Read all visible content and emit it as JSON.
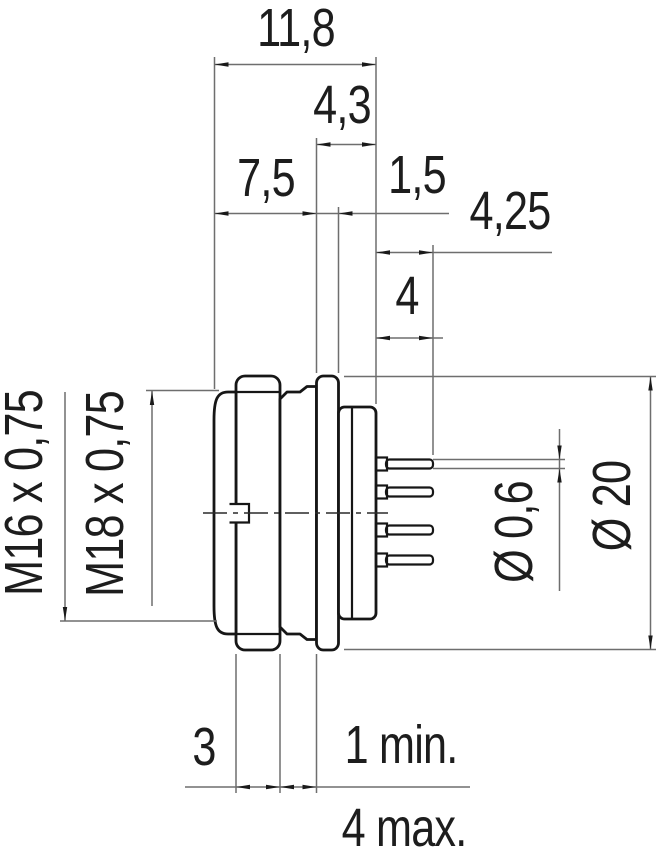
{
  "drawing": {
    "type": "connector-dimensional-drawing",
    "labels": {
      "total_length": "11,8",
      "rear_section_length": "4,3",
      "front_length": "7,5",
      "flange_thickness": "1,5",
      "pin_length": "4,25",
      "pin_tail": "4",
      "locknut_width": "3",
      "panel_thickness_min": "1 min.",
      "panel_thickness_max": "4 max.",
      "coupling_thread": "M16 x 0,75",
      "mounting_thread": "M18 x 0,75",
      "pin_diameter": "Ø 0,6",
      "flange_diameter": "Ø 20"
    },
    "colors": {
      "outline": "#161616",
      "dimension_lines": "#6e6e6e",
      "arrows": "#1a1a1a",
      "text": "#1d1d1d",
      "background": "#ffffff"
    }
  }
}
